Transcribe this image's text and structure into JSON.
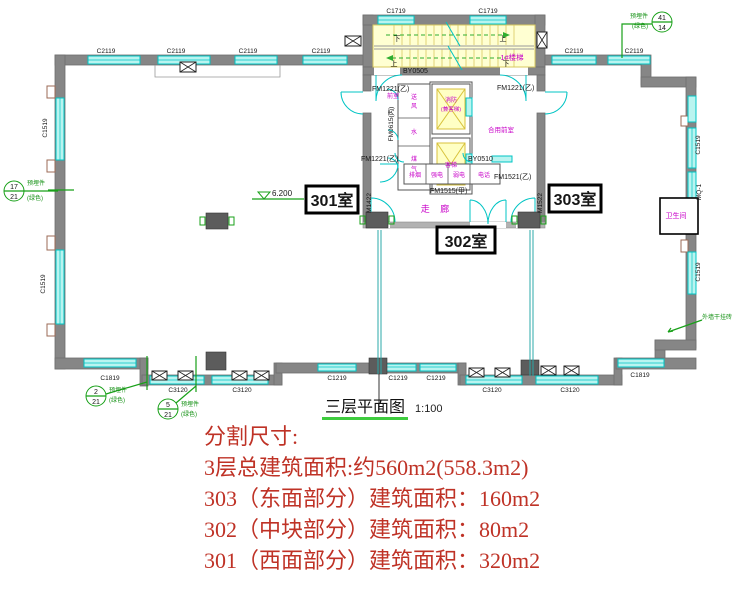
{
  "plan": {
    "title": "三层平面图",
    "scale": "1:100",
    "level_mark": "6.200",
    "rooms": {
      "room301": "301室",
      "room302": "302室",
      "room303": "303室",
      "corridor": "走 廊",
      "front_room": "前室",
      "shared_front_room": "合用前室",
      "bathroom": "卫生间",
      "stair_name": "1#楼梯",
      "elev_fire_1": "消防",
      "elev_fire_2": "(兼客梯)",
      "elev_passenger": "客梯",
      "up": "上",
      "down": "下"
    },
    "shafts": {
      "air_supply": [
        "送",
        "风"
      ],
      "water": "水",
      "gas": [
        "煤",
        "气"
      ],
      "smoke_exhaust": "排烟",
      "strong_electric": "强电",
      "weak_electric": "弱电",
      "telephone": "电话"
    },
    "doors": {
      "by0505": "BY0505",
      "by0510": "BY0510",
      "fm1221": "FM1221(乙)",
      "fm0615": "FM0615(丙)",
      "fm1515": "FM1515(甲)",
      "fm1521": "FM1521(乙)",
      "m1422": "M1422",
      "m1522": "M1522"
    },
    "windows": {
      "c2119": "C2119",
      "c1719": "C1719",
      "c1519": "C1519",
      "c1819": "C1819",
      "c3120": "C3120",
      "c1219": "C1219",
      "mq1": "MQ-1"
    },
    "grid_bubbles": [
      {
        "top": "17",
        "bottom": "21"
      },
      {
        "top": "41",
        "bottom": "14"
      },
      {
        "top": "2",
        "bottom": "21"
      },
      {
        "top": "5",
        "bottom": "21"
      }
    ],
    "green_notes": {
      "embed_1": "预埋件",
      "embed_2": "(绿色)",
      "facade": "外墙干挂砖"
    }
  },
  "notes": {
    "heading": "分割尺寸:",
    "lines": [
      "3层总建筑面积:约560m2(558.3m2)",
      "303（东面部分）建筑面积：160m2",
      "302（中块部分）建筑面积：80m2",
      "301（西面部分）建筑面积：320m2"
    ]
  },
  "colors": {
    "window_cyan": "#00c4c4",
    "stair_yellow": "#ffffd2",
    "label_magenta": "#c800c8",
    "note_red": "#bf3226",
    "marker_green": "#18a018"
  }
}
